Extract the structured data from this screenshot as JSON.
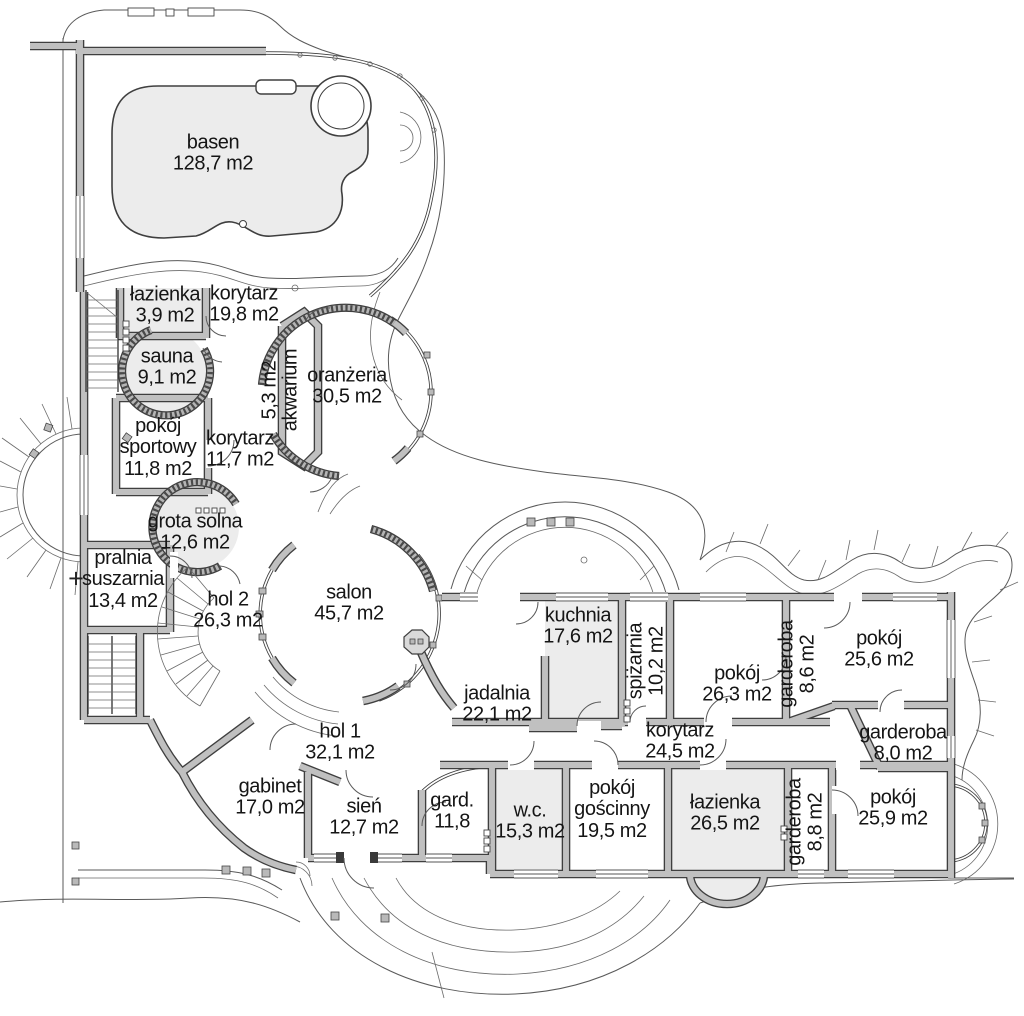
{
  "drawing": {
    "type": "floor-plan",
    "language": "pl",
    "area_unit": "m2"
  },
  "rooms": [
    {
      "id": "basen",
      "name": "basen",
      "area": "128,7 m2",
      "lines": [
        "basen",
        "128,7 m2"
      ],
      "x": 213,
      "y": 154,
      "vertical": false
    },
    {
      "id": "lazienka-goraca",
      "name": "łazienka",
      "area": "3,9 m2",
      "lines": [
        "łazienka",
        "3,9 m2"
      ],
      "x": 165,
      "y": 306,
      "vertical": false
    },
    {
      "id": "korytarz-basenowy",
      "name": "korytarz",
      "area": "19,8 m2",
      "lines": [
        "korytarz",
        "19,8 m2"
      ],
      "x": 244,
      "y": 305,
      "vertical": false
    },
    {
      "id": "sauna",
      "name": "sauna",
      "area": "9,1 m2",
      "lines": [
        "sauna",
        "9,1 m2"
      ],
      "x": 167,
      "y": 368,
      "vertical": false
    },
    {
      "id": "akwarium",
      "name": "akwarium",
      "area": "5,3 m2",
      "lines": [
        "5,3 m2",
        "akwarium"
      ],
      "x": 281,
      "y": 390,
      "vertical": true
    },
    {
      "id": "oranzeria",
      "name": "oranżeria",
      "area": "30,5 m2",
      "lines": [
        "oranżeria",
        "30,5 m2"
      ],
      "x": 347,
      "y": 387,
      "vertical": false
    },
    {
      "id": "pokoj-sportowy",
      "name": "pokój sportowy",
      "area": "11,8 m2",
      "lines": [
        "pokój",
        "sportowy",
        "11,8 m2"
      ],
      "x": 158,
      "y": 448,
      "vertical": false
    },
    {
      "id": "korytarz-gorny",
      "name": "korytarz",
      "area": "11,7 m2",
      "lines": [
        "korytarz",
        "11,7 m2"
      ],
      "x": 240,
      "y": 450,
      "vertical": false
    },
    {
      "id": "grota-solna",
      "name": "grota solna",
      "area": "12,6 m2",
      "lines": [
        "grota solna",
        "12,6 m2"
      ],
      "x": 195,
      "y": 533,
      "vertical": false
    },
    {
      "id": "pralnia-suszarnia",
      "name": "pralnia suszarnia",
      "area": "13,4 m2",
      "lines": [
        "pralnia",
        "suszarnia",
        "13,4 m2"
      ],
      "x": 123,
      "y": 580,
      "vertical": false
    },
    {
      "id": "hol-2",
      "name": "hol 2",
      "area": "26,3 m2",
      "lines": [
        "hol 2",
        "26,3 m2"
      ],
      "x": 228,
      "y": 611,
      "vertical": false
    },
    {
      "id": "salon",
      "name": "salon",
      "area": "45,7 m2",
      "lines": [
        "salon",
        "45,7 m2"
      ],
      "x": 349,
      "y": 604,
      "vertical": false
    },
    {
      "id": "kuchnia",
      "name": "kuchnia",
      "area": "17,6 m2",
      "lines": [
        "kuchnia",
        "17,6 m2"
      ],
      "x": 578,
      "y": 627,
      "vertical": false
    },
    {
      "id": "spizarnia",
      "name": "spiżarnia",
      "area": "10,2 m2",
      "lines": [
        "spiżarnia",
        "10,2 m2"
      ],
      "x": 647,
      "y": 661,
      "vertical": true
    },
    {
      "id": "pokoj-26",
      "name": "pokój",
      "area": "26,3 m2",
      "lines": [
        "pokój",
        "26,3 m2"
      ],
      "x": 737,
      "y": 685,
      "vertical": false
    },
    {
      "id": "garderoba-86",
      "name": "garderoba",
      "area": "8,6 m2",
      "lines": [
        "garderoba",
        "8,6 m2"
      ],
      "x": 798,
      "y": 664,
      "vertical": true
    },
    {
      "id": "pokoj-256",
      "name": "pokój",
      "area": "25,6 m2",
      "lines": [
        "pokój",
        "25,6 m2"
      ],
      "x": 879,
      "y": 650,
      "vertical": false
    },
    {
      "id": "garderoba-80",
      "name": "garderoba",
      "area": "8,0 m2",
      "lines": [
        "garderoba",
        "8,0 m2"
      ],
      "x": 903,
      "y": 744,
      "vertical": false
    },
    {
      "id": "jadalnia",
      "name": "jadalnia",
      "area": "22,1 m2",
      "lines": [
        "jadalnia",
        "22,1 m2"
      ],
      "x": 497,
      "y": 705,
      "vertical": false
    },
    {
      "id": "korytarz-nocny",
      "name": "korytarz",
      "area": "24,5 m2",
      "lines": [
        "korytarz",
        "24,5 m2"
      ],
      "x": 680,
      "y": 742,
      "vertical": false
    },
    {
      "id": "hol-1",
      "name": "hol 1",
      "area": "32,1 m2",
      "lines": [
        "hol 1",
        "32,1 m2"
      ],
      "x": 340,
      "y": 743,
      "vertical": false
    },
    {
      "id": "gabinet",
      "name": "gabinet",
      "area": "17,0 m2",
      "lines": [
        "gabinet",
        "17,0 m2"
      ],
      "x": 270,
      "y": 798,
      "vertical": false
    },
    {
      "id": "sien",
      "name": "sień",
      "area": "12,7 m2",
      "lines": [
        "sień",
        "12,7 m2"
      ],
      "x": 364,
      "y": 818,
      "vertical": false
    },
    {
      "id": "gard",
      "name": "gard.",
      "area": "11,8",
      "lines": [
        "gard.",
        "11,8"
      ],
      "x": 452,
      "y": 812,
      "vertical": false
    },
    {
      "id": "wc",
      "name": "w.c.",
      "area": "15,3 m2",
      "lines": [
        "w.c.",
        "15,3 m2"
      ],
      "x": 530,
      "y": 822,
      "vertical": false
    },
    {
      "id": "pokoj-goscinny",
      "name": "pokój gościnny",
      "area": "19,5 m2",
      "lines": [
        "pokój",
        "gościnny",
        "19,5 m2"
      ],
      "x": 612,
      "y": 810,
      "vertical": false
    },
    {
      "id": "lazienka-nocna",
      "name": "łazienka",
      "area": "26,5 m2",
      "lines": [
        "łazienka",
        "26,5 m2"
      ],
      "x": 725,
      "y": 814,
      "vertical": false
    },
    {
      "id": "garderoba-88",
      "name": "garderoba",
      "area": "8,8 m2",
      "lines": [
        "garderoba",
        "8,8 m2"
      ],
      "x": 806,
      "y": 822,
      "vertical": true
    },
    {
      "id": "pokoj-259",
      "name": "pokój",
      "area": "25,9 m2",
      "lines": [
        "pokój",
        "25,9 m2"
      ],
      "x": 893,
      "y": 809,
      "vertical": false
    }
  ],
  "markers": [
    {
      "id": "level-cross",
      "text": "+",
      "x": 76,
      "y": 579
    }
  ],
  "colors": {
    "wall_fill": "#c0c0c0",
    "wall_edge": "#3f3f3f",
    "room_tint": "#ececec",
    "line": "#5a5a5a",
    "text": "#151515",
    "background": "#ffffff"
  }
}
